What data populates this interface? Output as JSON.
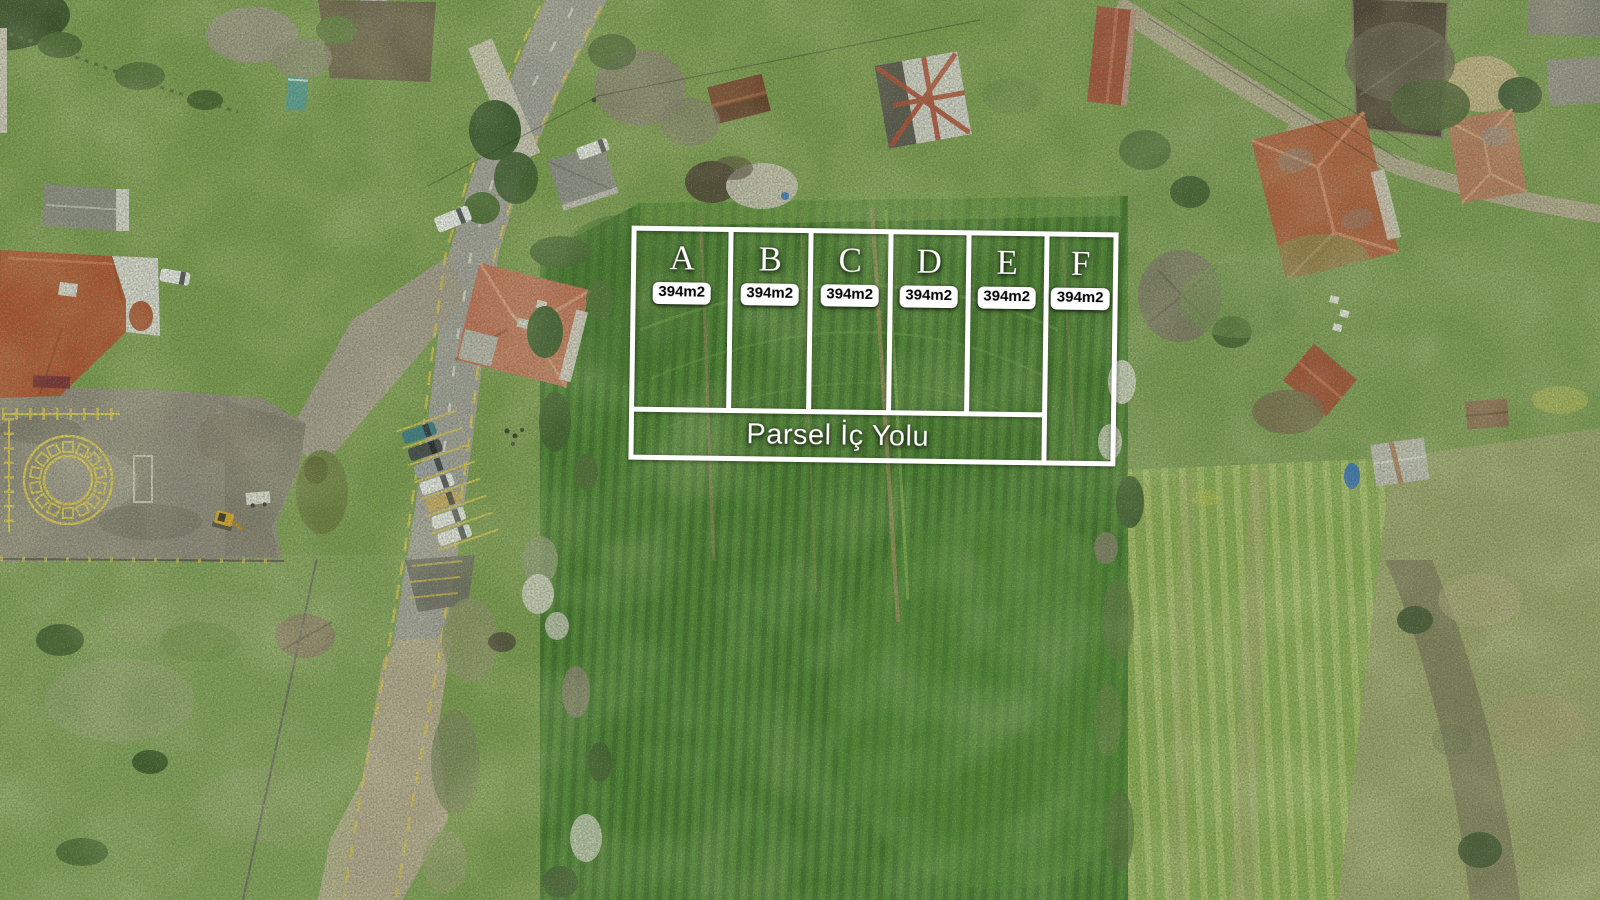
{
  "overlay": {
    "parcels": [
      {
        "label": "A",
        "area": "394m2"
      },
      {
        "label": "B",
        "area": "394m2"
      },
      {
        "label": "C",
        "area": "394m2"
      },
      {
        "label": "D",
        "area": "394m2"
      },
      {
        "label": "E",
        "area": "394m2"
      },
      {
        "label": "F",
        "area": "394m2"
      }
    ],
    "road_label": "Parsel İç Yolu"
  },
  "colors": {
    "overlay_line": "#ffffff",
    "badge_bg": "#ffffff",
    "badge_text": "#000000",
    "field_green": "#4a8030",
    "meadow_green": "#82a058",
    "road_gray": "#a3a19b",
    "marking_yellow": "#d9c44e",
    "roof_red": "#b0512e",
    "tarp_blue": "#2e6ec0"
  }
}
